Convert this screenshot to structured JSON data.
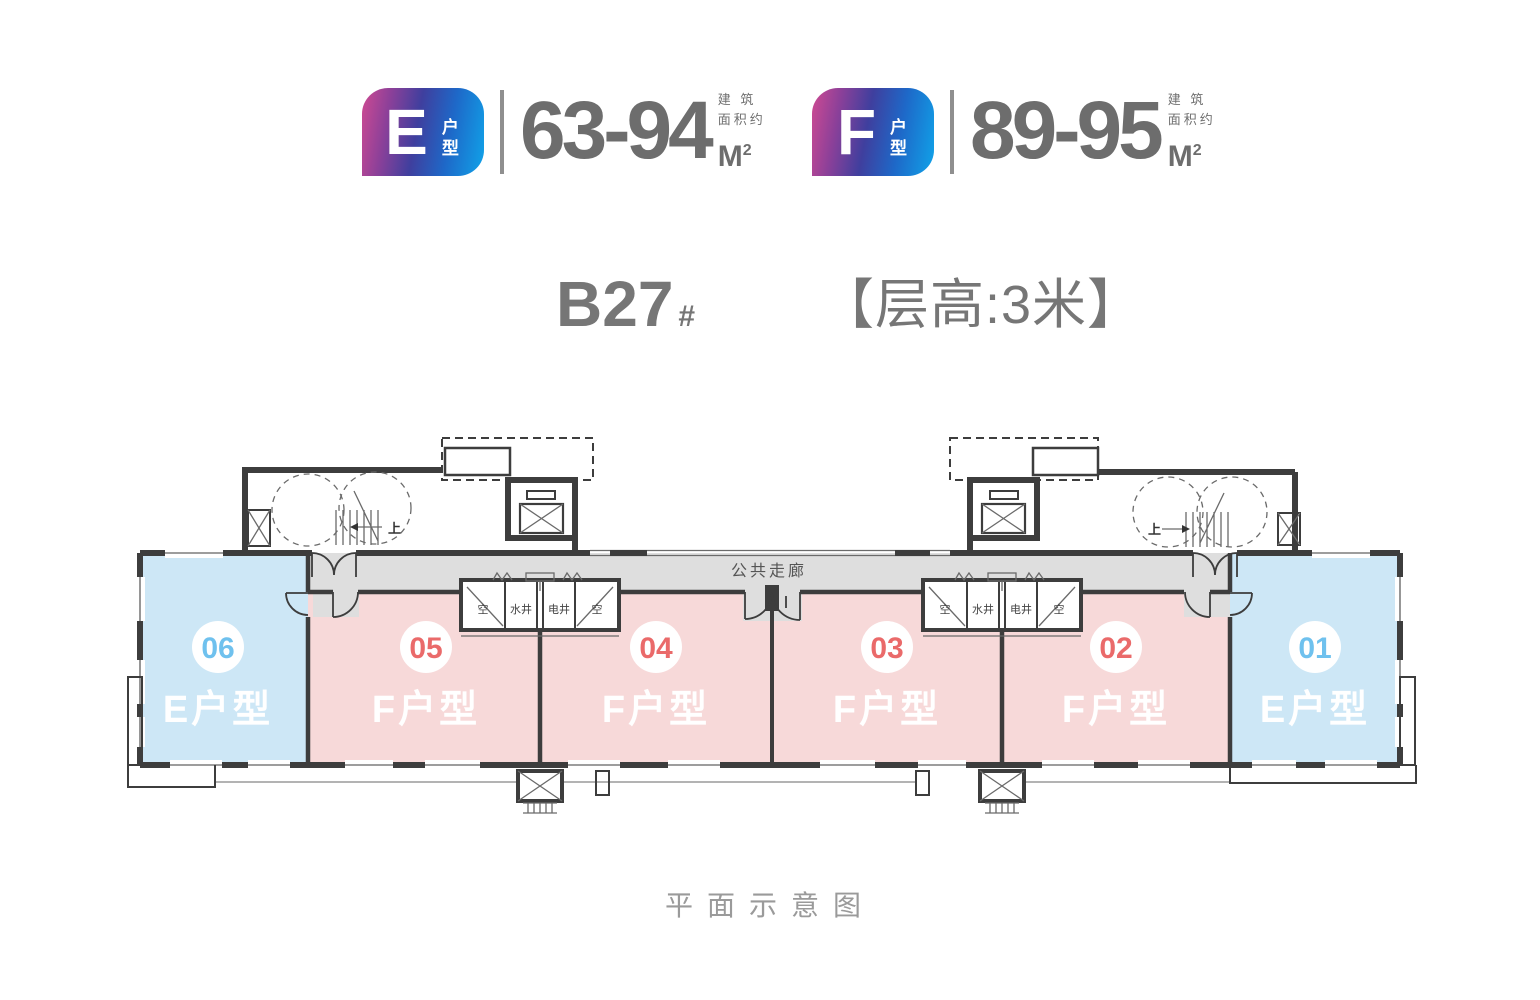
{
  "legend": {
    "items": [
      {
        "letter": "E",
        "type_chars": "户型",
        "range": "63-94",
        "area_unit": "M",
        "area_sup": "2",
        "note_line1": "建 筑",
        "note_line2": "面积约"
      },
      {
        "letter": "F",
        "type_chars": "户型",
        "range": "89-95",
        "area_unit": "M",
        "area_sup": "2",
        "note_line1": "建 筑",
        "note_line2": "面积约"
      }
    ]
  },
  "title": {
    "block": "B27",
    "block_suffix": "#",
    "floor_height": "【层高:3米】"
  },
  "plan": {
    "corridor_label": "公共走廊",
    "stairs_up": "上",
    "shafts": {
      "ac": "空",
      "water": "水井",
      "electric": "电井"
    },
    "units": [
      {
        "no": "06",
        "type": "E户型",
        "fill": "#cde7f6",
        "no_color": "#6fc1ee"
      },
      {
        "no": "05",
        "type": "F户型",
        "fill": "#f7d9d9",
        "no_color": "#ea6a6a"
      },
      {
        "no": "04",
        "type": "F户型",
        "fill": "#f7d9d9",
        "no_color": "#ea6a6a"
      },
      {
        "no": "03",
        "type": "F户型",
        "fill": "#f7d9d9",
        "no_color": "#ea6a6a"
      },
      {
        "no": "02",
        "type": "F户型",
        "fill": "#f7d9d9",
        "no_color": "#ea6a6a"
      },
      {
        "no": "01",
        "type": "E户型",
        "fill": "#cde7f6",
        "no_color": "#6fc1ee"
      }
    ]
  },
  "footer": {
    "caption": "平面示意图"
  },
  "colors": {
    "badge_gradient_start": "#cf4a92",
    "badge_gradient_end": "#10a3e9",
    "unit_pink": "#f7d9d9",
    "unit_blue": "#cde7f6",
    "corridor_gray": "#dedede",
    "wall": "#3d3d3d",
    "number_gray": "#6d6d6d",
    "title_gray": "#767676"
  }
}
